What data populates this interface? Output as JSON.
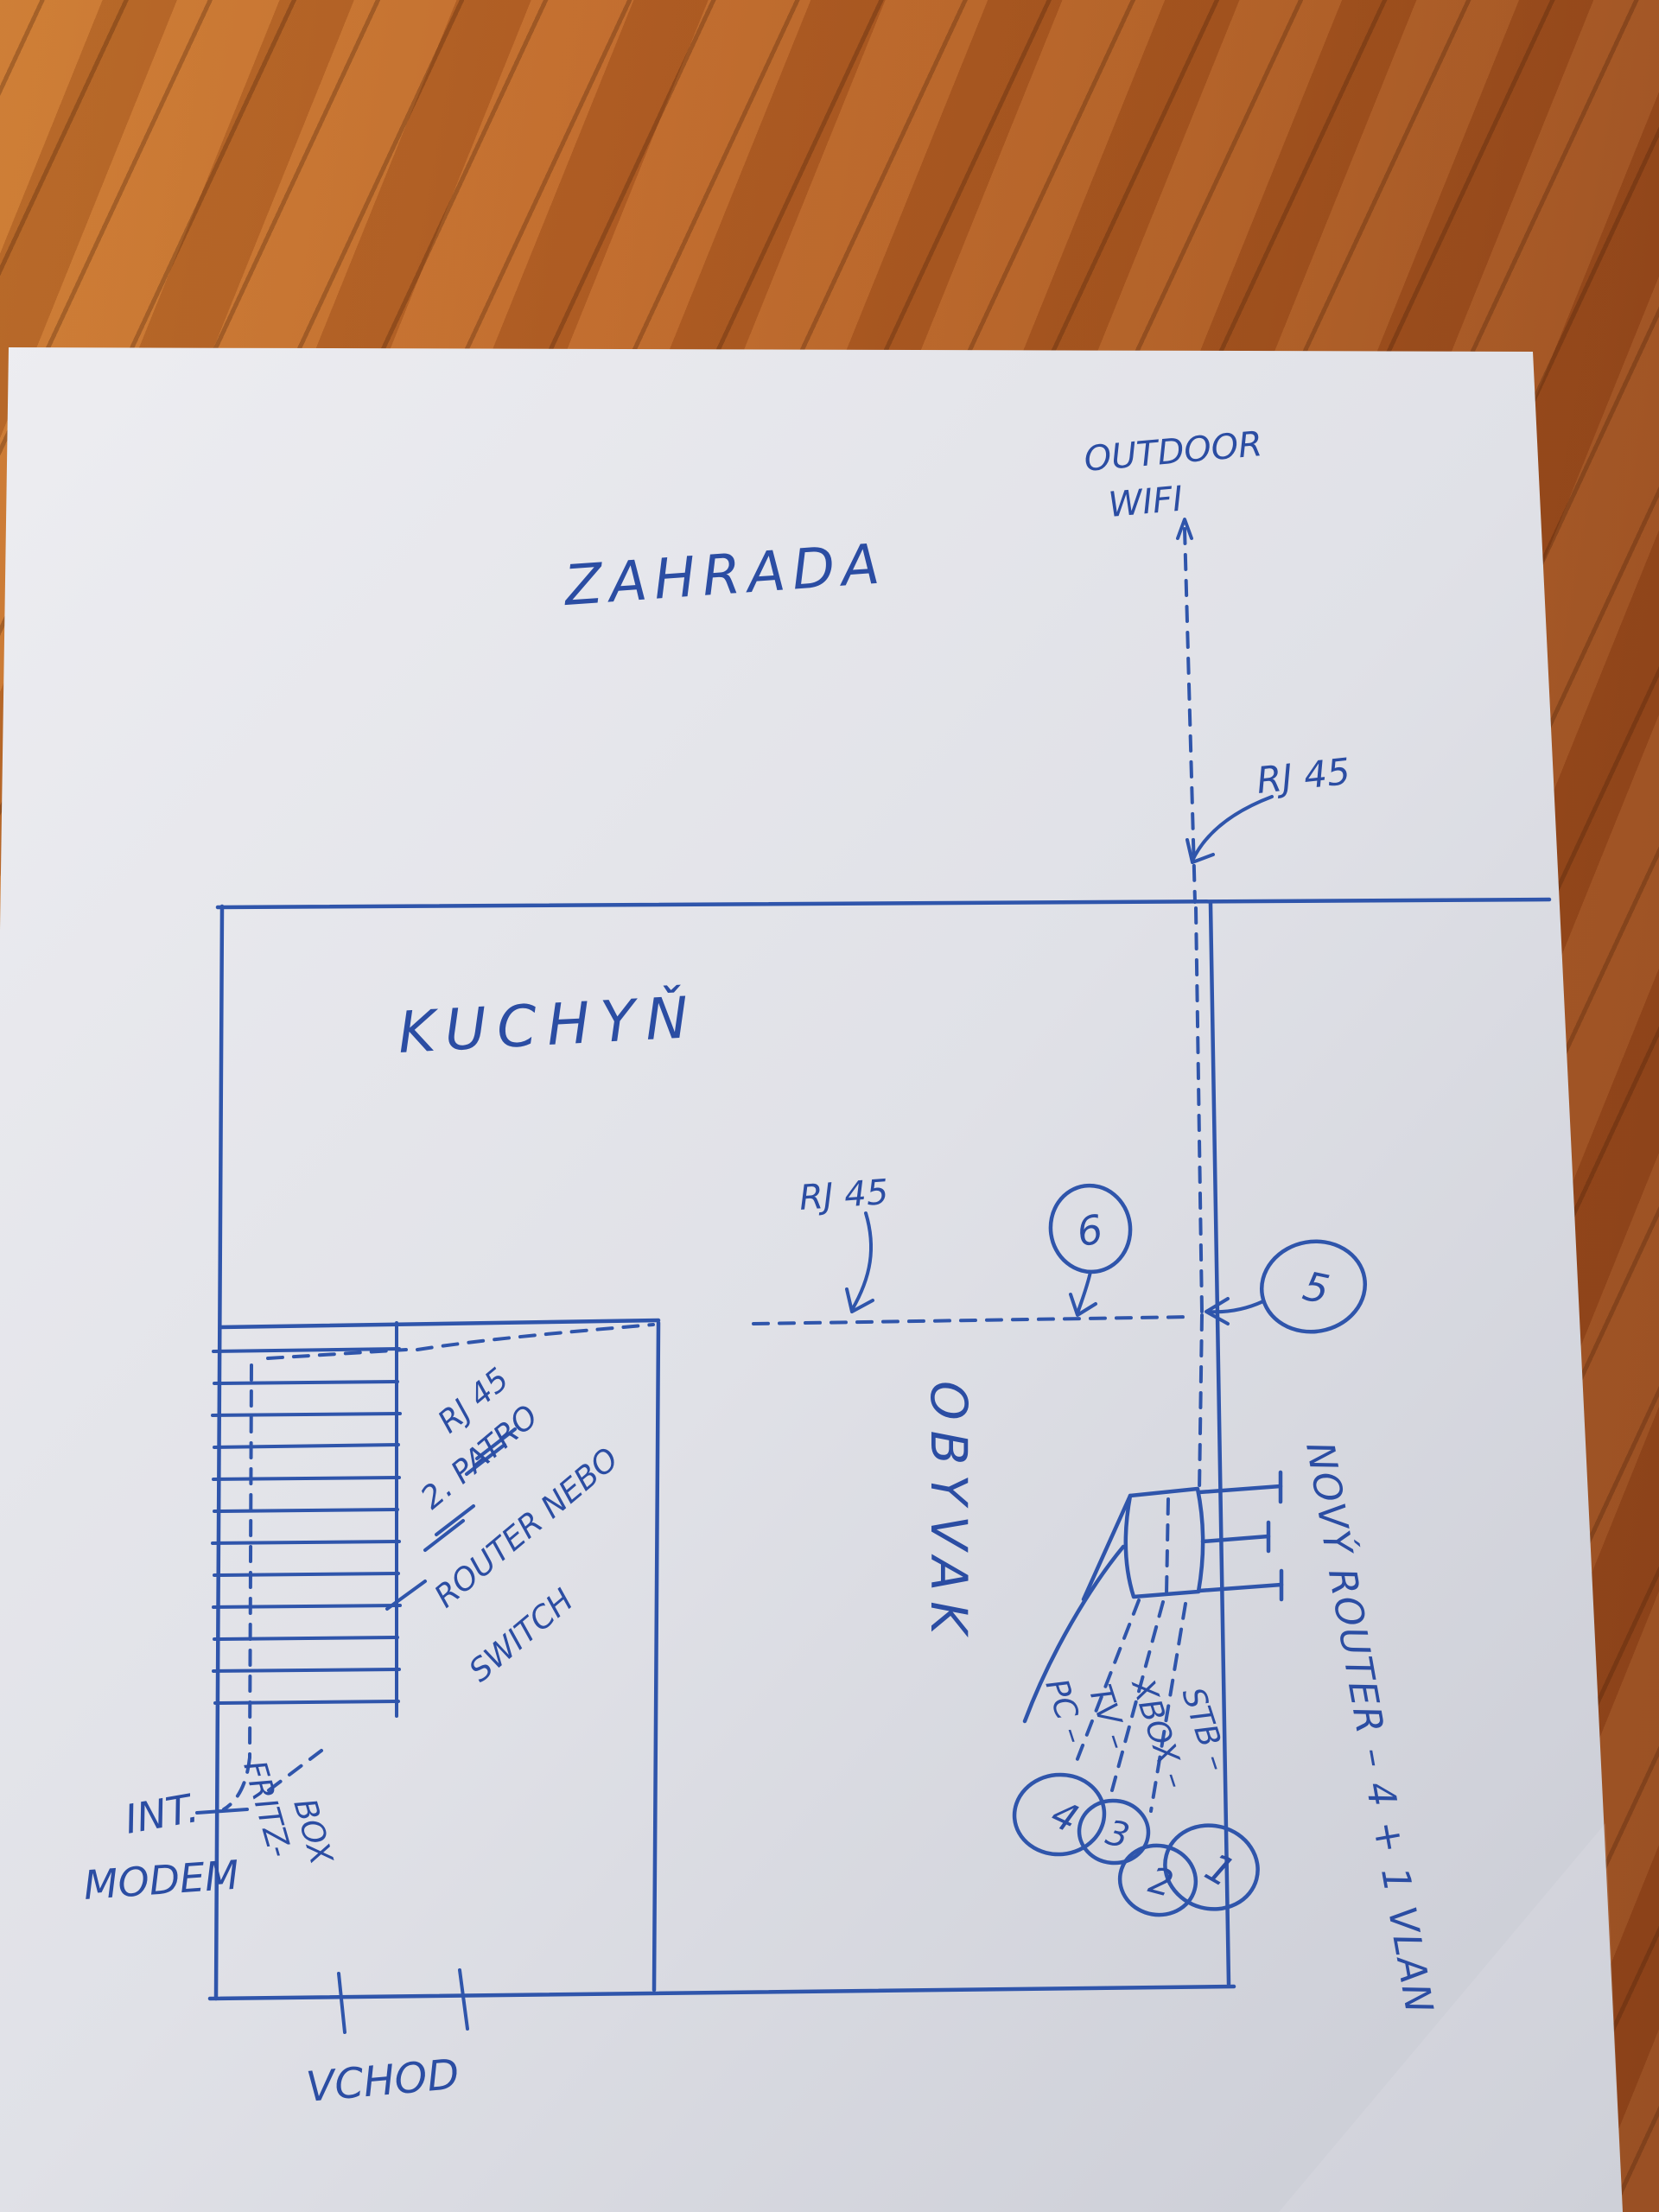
{
  "sketch": {
    "labels": {
      "zahrada": "ZAHRADA",
      "outdoor_wifi_1": "OUTDOOR",
      "outdoor_wifi_2": "WIFI",
      "rj45_top": "RJ 45",
      "kuchyn": "KUCHYŇ",
      "rj45_mid": "RJ 45",
      "obyvak": "OBYVAK",
      "stairs_1": "RJ 45",
      "stairs_2": "2. PATRO",
      "stairs_3": "ROUTER NEBO",
      "stairs_4": "SWITCH",
      "novy_router": "NOVÝ ROUTER – 4 + 1 VLAN",
      "device_stb": "STB –",
      "device_xbox": "XBOX –",
      "device_tv": "TV –",
      "device_pc": "PC –",
      "int_modem_1": "INT.",
      "int_modem_2": "MODEM",
      "fritz_1": "FRITZ-",
      "fritz_2": "BOX",
      "vchod": "VCHOD",
      "num_1": "1",
      "num_2": "2",
      "num_3": "3",
      "num_4": "4",
      "num_5": "5",
      "num_6": "6"
    },
    "colors": {
      "pen_blue": "#2f55ab",
      "paper": "#e2e3e9",
      "wood": "#a9561f"
    }
  }
}
